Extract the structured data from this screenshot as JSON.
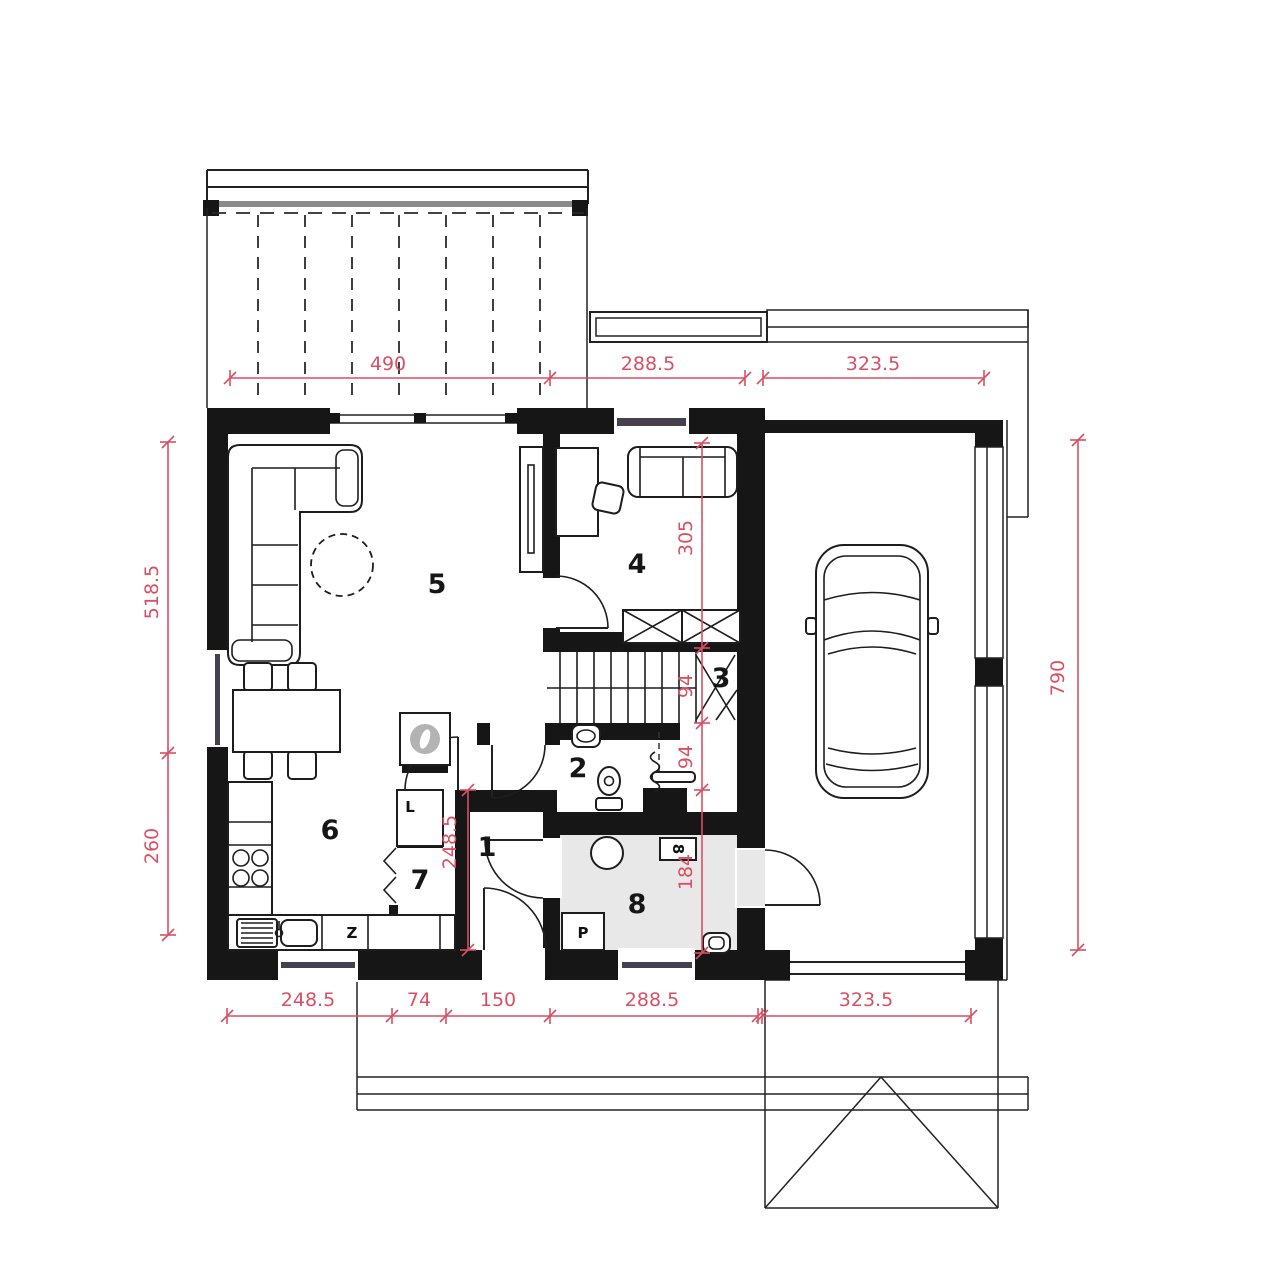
{
  "plan_title": "ground-floor-plan",
  "rooms": [
    "1",
    "2",
    "3",
    "4",
    "5",
    "6",
    "7",
    "8"
  ],
  "dimensions": {
    "top": [
      "490",
      "288.5",
      "323.5"
    ],
    "bottom": [
      "248.5",
      "74",
      "150",
      "288.5",
      "323.5"
    ],
    "left": [
      "518.5",
      "260"
    ],
    "right": [
      "790"
    ],
    "inner": [
      "305",
      "94",
      "94",
      "184"
    ],
    "hall": "248.5"
  },
  "markers": {
    "wardrobe": "L",
    "freezer": "Z",
    "washer": "P",
    "meter": "8"
  },
  "colors": {
    "wall": "#161616",
    "dimension": "#d94f63",
    "glazing": "#453f4e",
    "room8_floor": "#e8e8e8",
    "appliance_grey": "#b3b3b3",
    "deck_edge": "#8a8a8a"
  }
}
